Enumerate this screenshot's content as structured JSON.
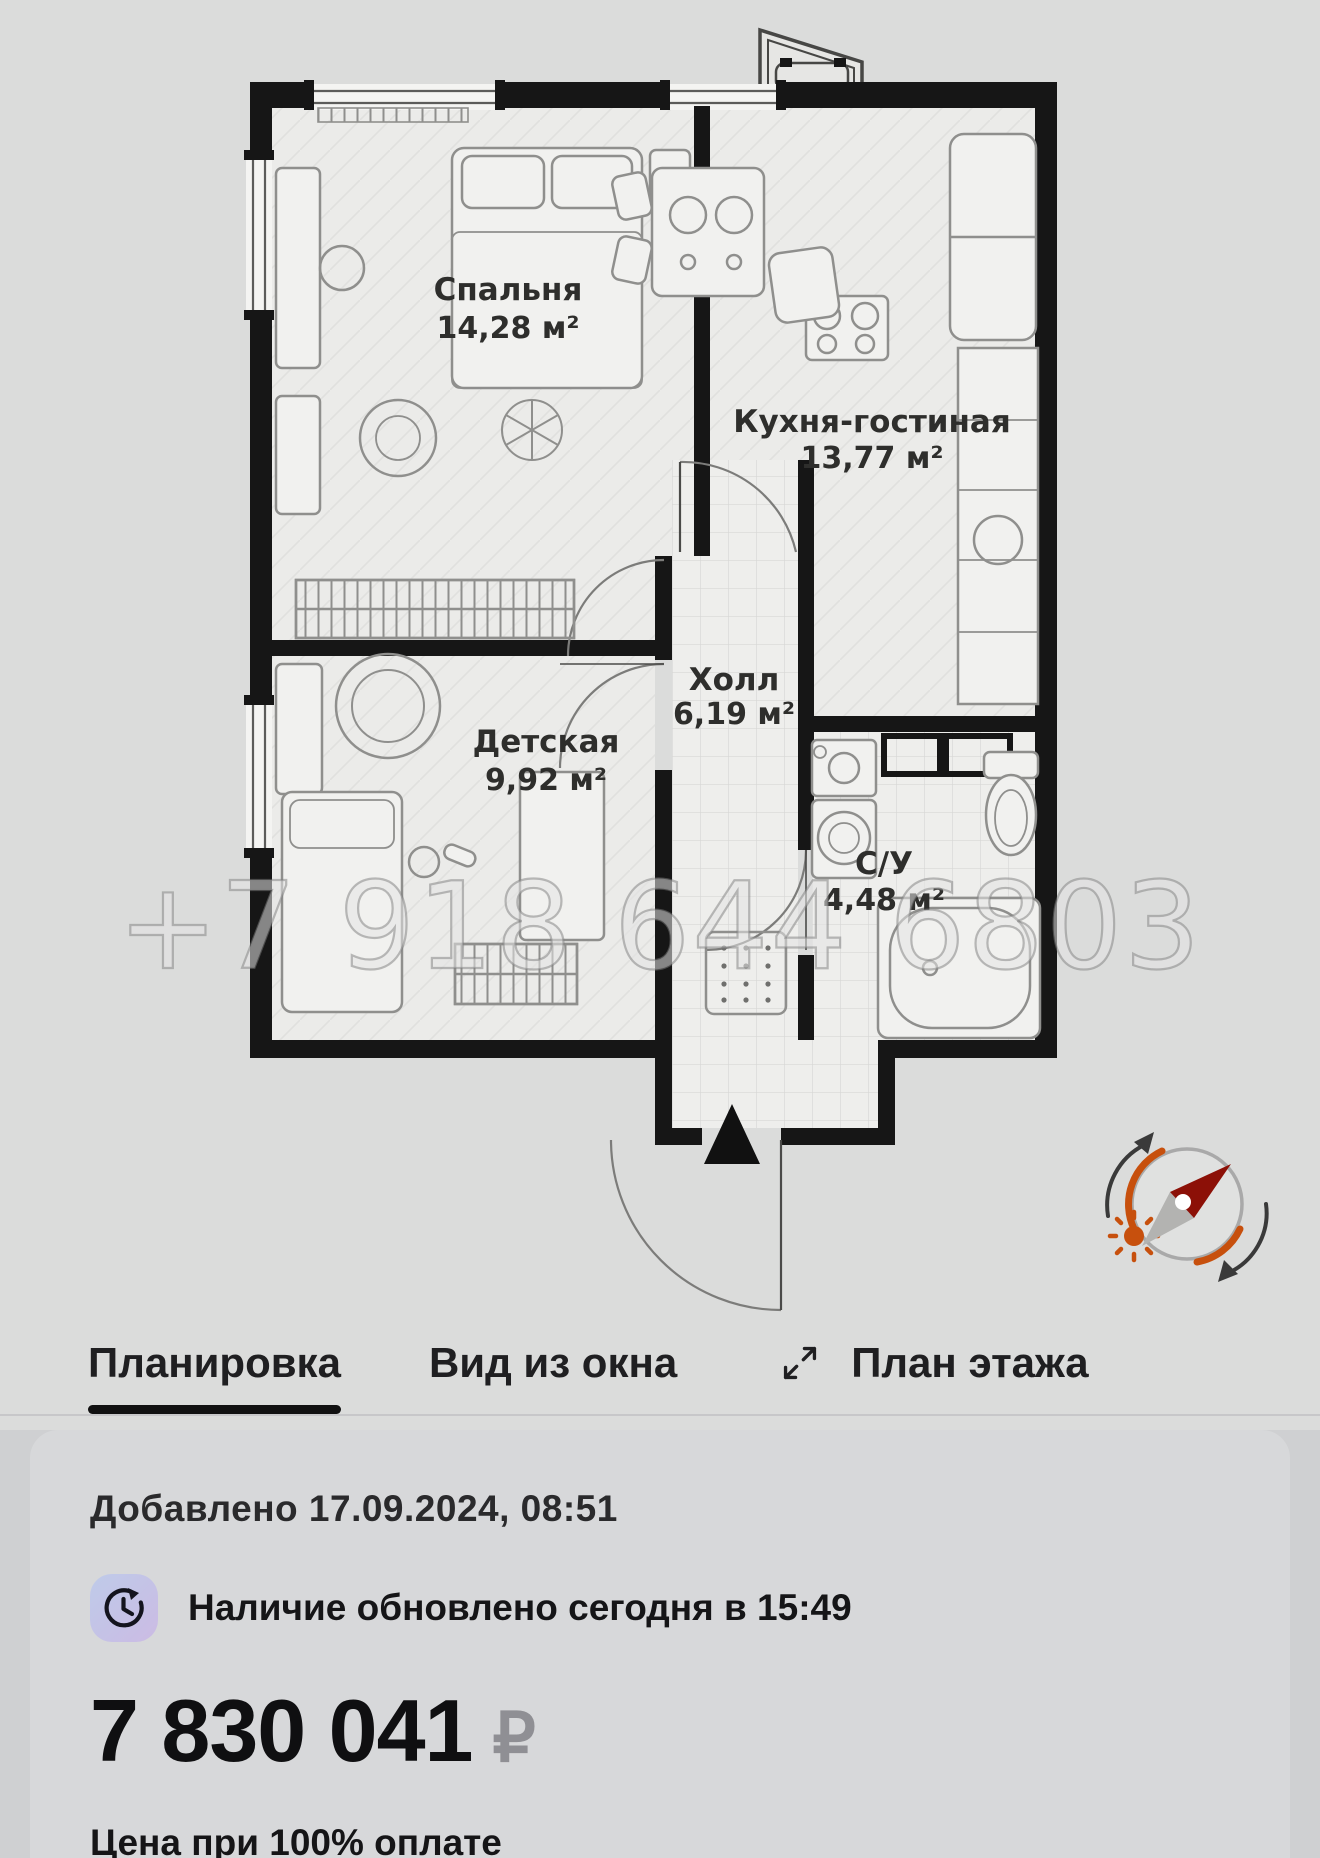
{
  "plan": {
    "rooms": [
      {
        "name": "Спальня",
        "area": "14,28 м²"
      },
      {
        "name": "Кухня-гостиная",
        "area": "13,77 м²"
      },
      {
        "name": "Холл",
        "area": "6,19 м²"
      },
      {
        "name": "Детская",
        "area": "9,92 м²"
      },
      {
        "name": "С/У",
        "area": "4,48 м²"
      }
    ],
    "watermark": "+7 918 644 6803"
  },
  "tabs": [
    {
      "label": "Планировка",
      "active": true
    },
    {
      "label": "Вид из окна",
      "active": false
    },
    {
      "label": "План этажа",
      "active": false
    }
  ],
  "info": {
    "added": "Добавлено 17.09.2024, 08:51",
    "availability": "Наличие обновлено сегодня в 15:49",
    "price": "7 830 041",
    "currency": "₽",
    "price_note": "Цена при 100% оплате"
  },
  "icons": {
    "expand": "expand-diagonal-icon",
    "availability": "clock-refresh-icon",
    "compass": "compass-icon",
    "entrance": "entrance-arrow-icon"
  },
  "colors": {
    "wall": "#161616",
    "accent_orange": "#c7500d",
    "needle_red": "#8c1007",
    "price_currency": "#8f8f94",
    "badge_gradient_start": "#bfcbe9",
    "badge_gradient_end": "#ccbbe4"
  }
}
